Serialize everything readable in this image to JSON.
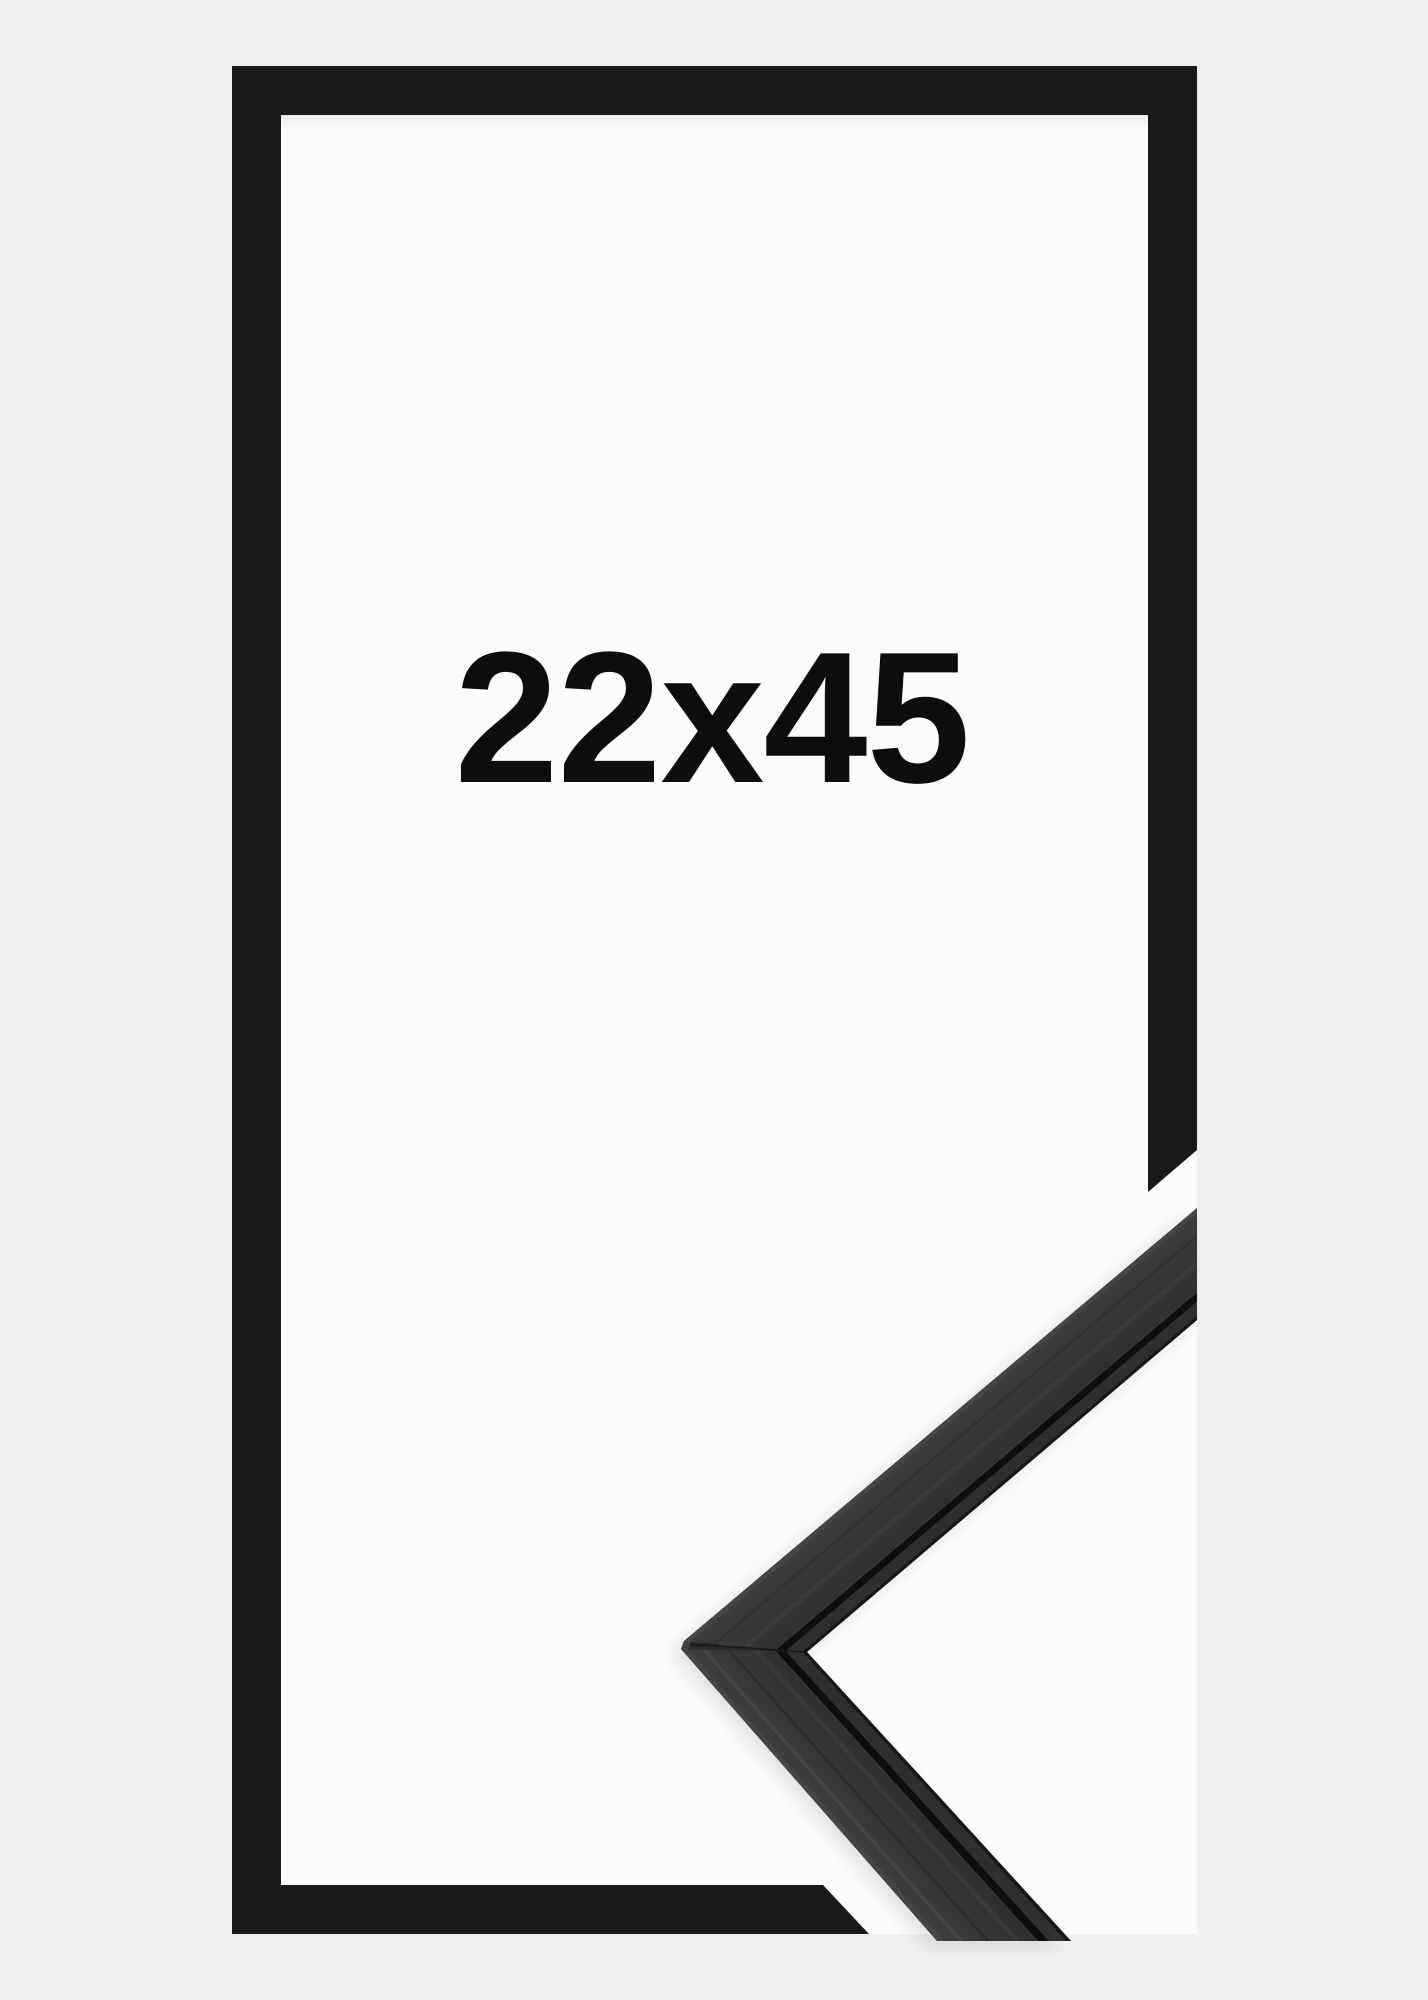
{
  "product": {
    "size_label": "22x45",
    "subject": "black wooden picture frame, portrait orientation, with moulding corner sample"
  },
  "colors": {
    "background": "#f0f0f1",
    "frame_black": "#1a1a1a",
    "interior_white": "#fcfcfc",
    "label_text": "#0d0d0d",
    "moulding_base": "#2a2a2a",
    "moulding_surface_light": "#3d3d3d",
    "moulding_surface_dark": "#2c2c2c",
    "moulding_bevel": "#4a4a4a",
    "moulding_groove": "#0e0e0e",
    "moulding_lip": "#2f2f2f"
  }
}
